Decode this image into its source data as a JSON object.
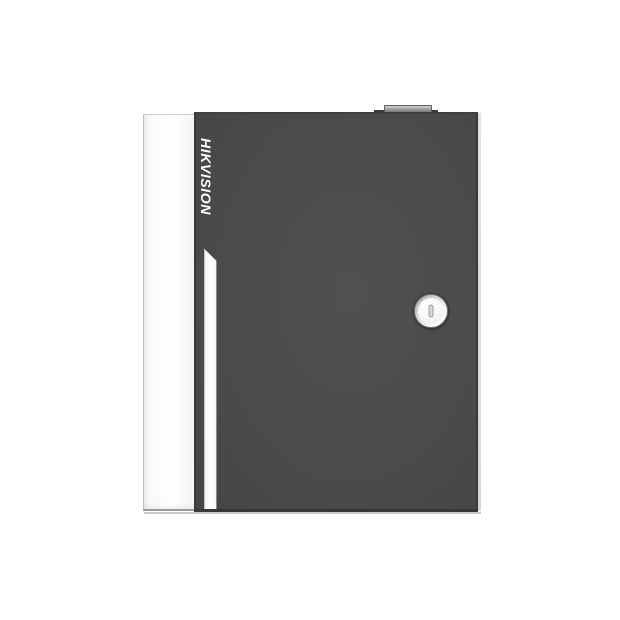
{
  "background_color": "#ffffff",
  "product": {
    "brand": "HIKVISION",
    "brand_text_color": "#ffffff",
    "door_color": "#4b4b4b",
    "side_panel_color": "#ffffff",
    "accent_stripe_color": "#ffffff",
    "lock_face_color": "#f4f4f4",
    "lock_slot_color": "#d8d8d8",
    "top_bump_color": "#a8a8a8"
  }
}
